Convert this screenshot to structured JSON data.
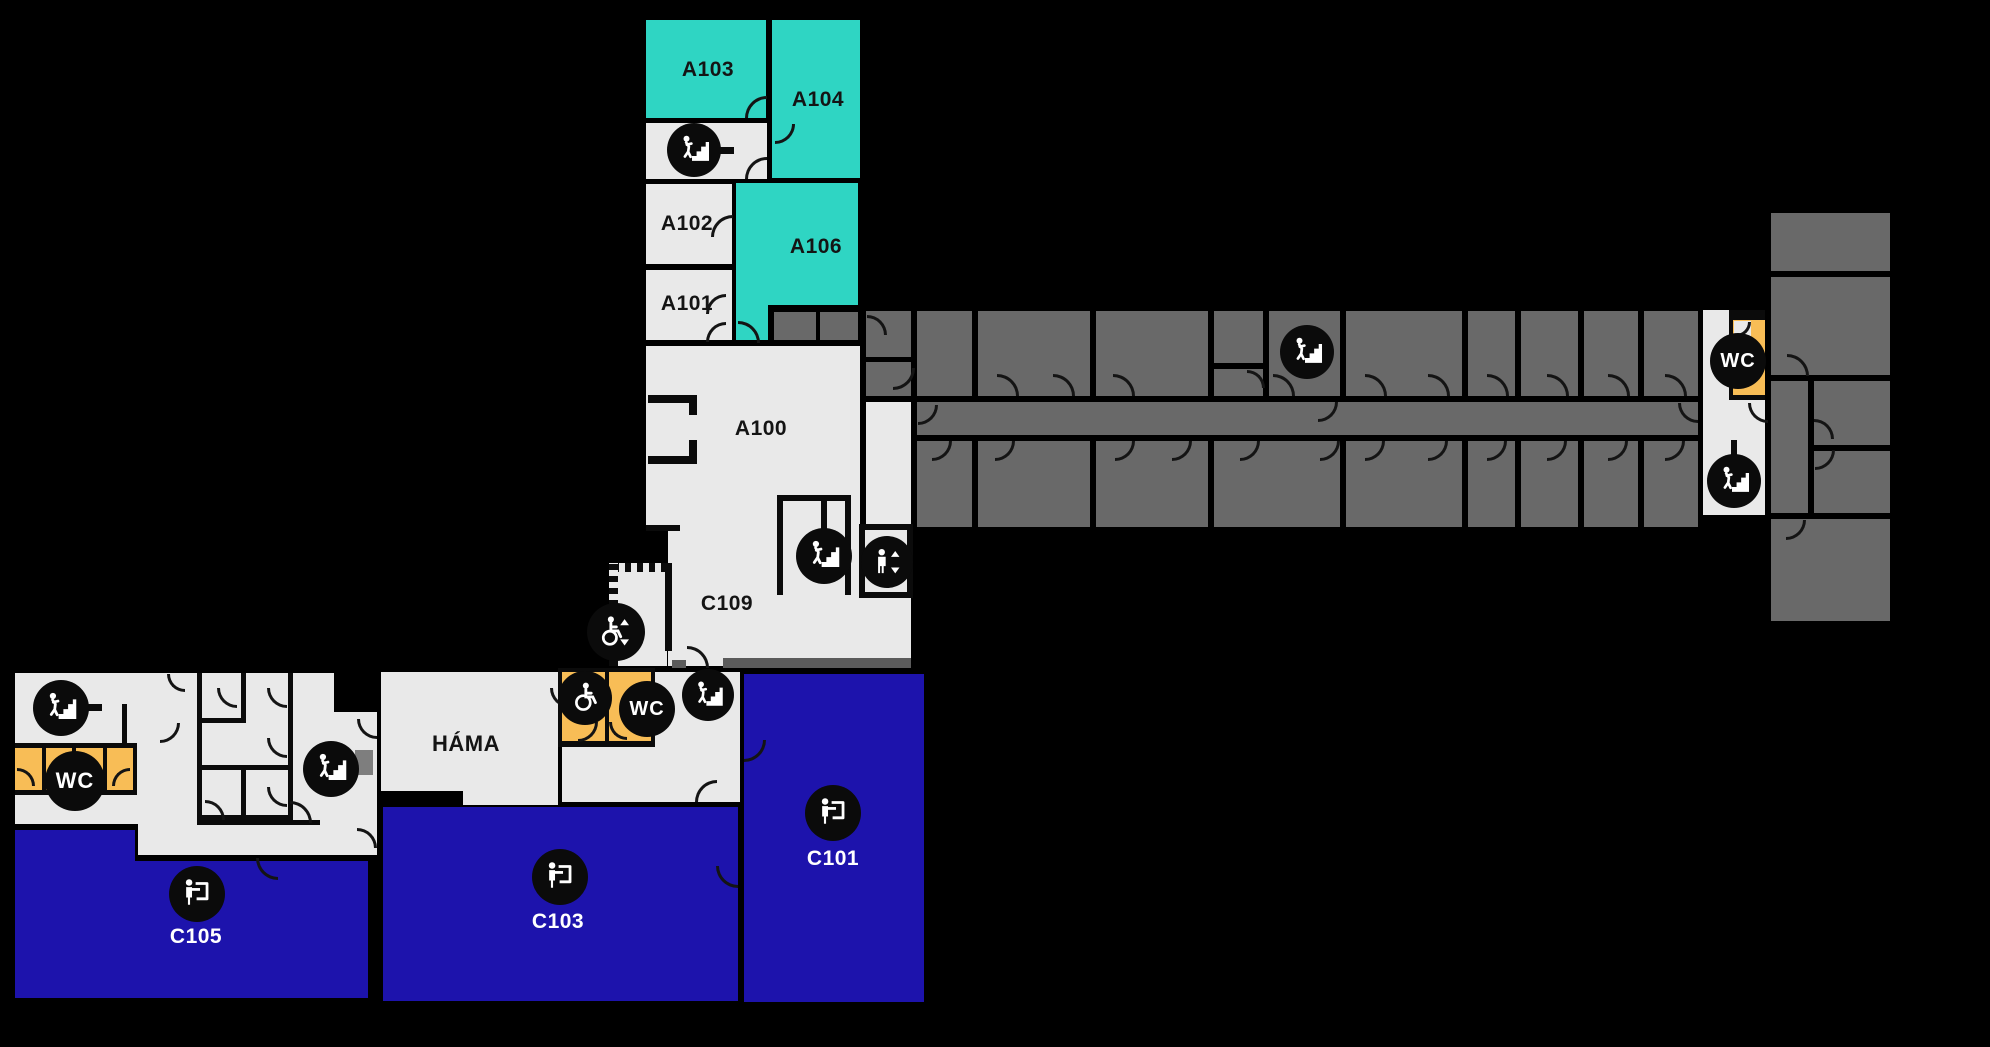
{
  "canvas": {
    "w": 1990,
    "h": 1047,
    "bg": "#000000"
  },
  "palette": {
    "wall": "#0B0B0B",
    "light": "#E9E9E9",
    "dark": "#696969",
    "teal": "#2FD5C3",
    "blue": "#1D13AC",
    "orange": "#F8BD56",
    "mid": "#5B5B5B",
    "mid2": "#7E7E7E",
    "label_dark": "#141414",
    "label_light": "#FFFFFF",
    "icon_bg": "#0B0B0B"
  },
  "rooms": [
    {
      "id": "a103",
      "x": 646,
      "y": 20,
      "w": 120,
      "h": 98,
      "fill": "teal"
    },
    {
      "id": "a104",
      "x": 772,
      "y": 20,
      "w": 88,
      "h": 158,
      "fill": "teal"
    },
    {
      "id": "stair-room-a",
      "x": 646,
      "y": 123,
      "w": 121,
      "h": 56,
      "fill": "light"
    },
    {
      "id": "a102",
      "x": 646,
      "y": 184,
      "w": 86,
      "h": 80,
      "fill": "light"
    },
    {
      "id": "a106",
      "x": 736,
      "y": 183,
      "w": 122,
      "h": 122,
      "fill": "teal"
    },
    {
      "id": "a106-ext",
      "x": 736,
      "y": 303,
      "w": 32,
      "h": 37,
      "fill": "teal"
    },
    {
      "id": "a101",
      "x": 646,
      "y": 270,
      "w": 86,
      "h": 70,
      "fill": "light"
    },
    {
      "id": "closet-1",
      "x": 774,
      "y": 312,
      "w": 42,
      "h": 28,
      "fill": "dark"
    },
    {
      "id": "closet-2",
      "x": 820,
      "y": 312,
      "w": 38,
      "h": 28,
      "fill": "dark"
    },
    {
      "id": "a100",
      "x": 646,
      "y": 346,
      "w": 214,
      "h": 185,
      "fill": "light"
    },
    {
      "id": "c109",
      "x": 668,
      "y": 527,
      "w": 243,
      "h": 139,
      "fill": "light"
    },
    {
      "id": "c109-ramp",
      "x": 613,
      "y": 565,
      "w": 54,
      "h": 101,
      "fill": "light"
    },
    {
      "id": "east-junction",
      "x": 866,
      "y": 402,
      "w": 45,
      "h": 128,
      "fill": "light"
    },
    {
      "id": "east-corridor",
      "x": 917,
      "y": 402,
      "w": 781,
      "h": 33,
      "fill": "dark"
    },
    {
      "id": "east-room-1a",
      "x": 866,
      "y": 311,
      "w": 45,
      "h": 46,
      "fill": "dark"
    },
    {
      "id": "east-room-1b",
      "x": 866,
      "y": 362,
      "w": 45,
      "h": 34,
      "fill": "dark"
    },
    {
      "id": "east-room-2",
      "x": 917,
      "y": 311,
      "w": 55,
      "h": 85,
      "fill": "dark"
    },
    {
      "id": "east-room-3",
      "x": 978,
      "y": 311,
      "w": 112,
      "h": 85,
      "fill": "dark"
    },
    {
      "id": "east-room-4",
      "x": 1096,
      "y": 311,
      "w": 112,
      "h": 85,
      "fill": "dark"
    },
    {
      "id": "east-room-5a",
      "x": 1214,
      "y": 311,
      "w": 49,
      "h": 52,
      "fill": "dark"
    },
    {
      "id": "east-room-5b",
      "x": 1214,
      "y": 369,
      "w": 49,
      "h": 27,
      "fill": "dark"
    },
    {
      "id": "east-stair-room",
      "x": 1269,
      "y": 311,
      "w": 71,
      "h": 85,
      "fill": "dark"
    },
    {
      "id": "east-room-6",
      "x": 1346,
      "y": 311,
      "w": 116,
      "h": 85,
      "fill": "dark"
    },
    {
      "id": "east-room-7",
      "x": 1468,
      "y": 311,
      "w": 47,
      "h": 85,
      "fill": "dark"
    },
    {
      "id": "east-room-8",
      "x": 1521,
      "y": 311,
      "w": 57,
      "h": 85,
      "fill": "dark"
    },
    {
      "id": "east-room-9",
      "x": 1584,
      "y": 311,
      "w": 54,
      "h": 85,
      "fill": "dark"
    },
    {
      "id": "east-room-10",
      "x": 1644,
      "y": 311,
      "w": 54,
      "h": 85,
      "fill": "dark"
    },
    {
      "id": "east-room-11",
      "x": 917,
      "y": 441,
      "w": 55,
      "h": 86,
      "fill": "dark"
    },
    {
      "id": "east-room-12",
      "x": 978,
      "y": 441,
      "w": 112,
      "h": 86,
      "fill": "dark"
    },
    {
      "id": "east-room-13",
      "x": 1096,
      "y": 441,
      "w": 112,
      "h": 86,
      "fill": "dark"
    },
    {
      "id": "east-room-14",
      "x": 1214,
      "y": 441,
      "w": 126,
      "h": 86,
      "fill": "dark"
    },
    {
      "id": "east-room-15",
      "x": 1346,
      "y": 441,
      "w": 116,
      "h": 86,
      "fill": "dark"
    },
    {
      "id": "east-room-16",
      "x": 1468,
      "y": 441,
      "w": 47,
      "h": 86,
      "fill": "dark"
    },
    {
      "id": "east-room-17",
      "x": 1521,
      "y": 441,
      "w": 57,
      "h": 86,
      "fill": "dark"
    },
    {
      "id": "east-room-18",
      "x": 1584,
      "y": 441,
      "w": 54,
      "h": 86,
      "fill": "dark"
    },
    {
      "id": "east-room-19",
      "x": 1644,
      "y": 441,
      "w": 54,
      "h": 86,
      "fill": "dark"
    },
    {
      "id": "east-end-hall",
      "x": 1703,
      "y": 310,
      "w": 62,
      "h": 205,
      "fill": "light"
    },
    {
      "id": "east-wc-frame",
      "x": 1729,
      "y": 310,
      "w": 36,
      "h": 90,
      "fill": "wall"
    },
    {
      "id": "east-wc",
      "x": 1733,
      "y": 320,
      "w": 32,
      "h": 75,
      "fill": "orange"
    },
    {
      "id": "east-wc-door-nook",
      "x": 1734,
      "y": 321,
      "w": 17,
      "h": 15,
      "fill": "light"
    },
    {
      "id": "far-room-1",
      "x": 1771,
      "y": 213,
      "w": 119,
      "h": 58,
      "fill": "dark"
    },
    {
      "id": "far-room-2",
      "x": 1771,
      "y": 277,
      "w": 119,
      "h": 98,
      "fill": "dark"
    },
    {
      "id": "far-room-3",
      "x": 1771,
      "y": 381,
      "w": 37,
      "h": 132,
      "fill": "dark"
    },
    {
      "id": "far-room-4",
      "x": 1814,
      "y": 381,
      "w": 76,
      "h": 64,
      "fill": "dark"
    },
    {
      "id": "far-room-5",
      "x": 1814,
      "y": 451,
      "w": 76,
      "h": 62,
      "fill": "dark"
    },
    {
      "id": "far-room-6",
      "x": 1771,
      "y": 519,
      "w": 119,
      "h": 102,
      "fill": "dark"
    },
    {
      "id": "west-base",
      "x": 15,
      "y": 673,
      "w": 319,
      "h": 151,
      "fill": "light"
    },
    {
      "id": "west-annex",
      "x": 334,
      "y": 712,
      "w": 43,
      "h": 143,
      "fill": "light"
    },
    {
      "id": "west-strip",
      "x": 138,
      "y": 798,
      "w": 239,
      "h": 57,
      "fill": "light"
    },
    {
      "id": "west-stall-frame",
      "x": 15,
      "y": 743,
      "w": 122,
      "h": 52,
      "fill": "wall"
    },
    {
      "id": "west-stall-1",
      "x": 15,
      "y": 748,
      "w": 27,
      "h": 42,
      "fill": "orange"
    },
    {
      "id": "west-stall-2",
      "x": 46,
      "y": 748,
      "w": 26,
      "h": 42,
      "fill": "orange"
    },
    {
      "id": "west-stall-3",
      "x": 76,
      "y": 748,
      "w": 27,
      "h": 42,
      "fill": "orange"
    },
    {
      "id": "west-stall-4",
      "x": 107,
      "y": 748,
      "w": 26,
      "h": 42,
      "fill": "orange"
    },
    {
      "id": "hama",
      "x": 381,
      "y": 672,
      "w": 177,
      "h": 119,
      "fill": "light"
    },
    {
      "id": "hama-step",
      "x": 463,
      "y": 789,
      "w": 95,
      "h": 16,
      "fill": "light"
    },
    {
      "id": "south-hall",
      "x": 562,
      "y": 672,
      "w": 178,
      "h": 130,
      "fill": "light"
    },
    {
      "id": "south-wc-frame",
      "x": 558,
      "y": 668,
      "w": 97,
      "h": 79,
      "fill": "wall"
    },
    {
      "id": "acc-wc",
      "x": 562,
      "y": 672,
      "w": 43,
      "h": 69,
      "fill": "orange"
    },
    {
      "id": "south-wc",
      "x": 609,
      "y": 672,
      "w": 42,
      "h": 69,
      "fill": "orange"
    },
    {
      "id": "c101",
      "x": 744,
      "y": 674,
      "w": 180,
      "h": 328,
      "fill": "blue"
    },
    {
      "id": "c103",
      "x": 383,
      "y": 807,
      "w": 355,
      "h": 194,
      "fill": "blue"
    },
    {
      "id": "c105-left",
      "x": 15,
      "y": 830,
      "w": 120,
      "h": 168,
      "fill": "blue"
    },
    {
      "id": "c105-right",
      "x": 133,
      "y": 861,
      "w": 235,
      "h": 137,
      "fill": "blue"
    }
  ],
  "walls": [
    {
      "x": 646,
      "y": 525,
      "w": 34,
      "h": 6
    },
    {
      "x": 777,
      "y": 495,
      "w": 74,
      "h": 6
    },
    {
      "x": 777,
      "y": 495,
      "w": 6,
      "h": 100
    },
    {
      "x": 845,
      "y": 495,
      "w": 6,
      "h": 100
    },
    {
      "x": 821,
      "y": 499,
      "w": 6,
      "h": 32
    },
    {
      "x": 859,
      "y": 524,
      "w": 54,
      "h": 6
    },
    {
      "x": 859,
      "y": 524,
      "w": 6,
      "h": 74
    },
    {
      "x": 907,
      "y": 524,
      "w": 6,
      "h": 74
    },
    {
      "x": 859,
      "y": 592,
      "w": 54,
      "h": 6
    },
    {
      "x": 648,
      "y": 395,
      "w": 49,
      "h": 8
    },
    {
      "x": 689,
      "y": 395,
      "w": 8,
      "h": 20
    },
    {
      "x": 648,
      "y": 456,
      "w": 49,
      "h": 8
    },
    {
      "x": 689,
      "y": 440,
      "w": 8,
      "h": 24
    },
    {
      "x": 665,
      "y": 563,
      "w": 7,
      "h": 88
    },
    {
      "x": 613,
      "y": 563,
      "w": 54,
      "h": 9,
      "saw": "h"
    },
    {
      "x": 609,
      "y": 563,
      "w": 9,
      "h": 103,
      "saw": "v"
    },
    {
      "x": 672,
      "y": 660,
      "w": 14,
      "h": 8,
      "fill": "mid"
    },
    {
      "x": 723,
      "y": 658,
      "w": 188,
      "h": 10,
      "fill": "mid"
    },
    {
      "x": 197,
      "y": 673,
      "w": 5,
      "h": 147
    },
    {
      "x": 241,
      "y": 673,
      "w": 5,
      "h": 45
    },
    {
      "x": 197,
      "y": 718,
      "w": 49,
      "h": 5
    },
    {
      "x": 241,
      "y": 768,
      "w": 5,
      "h": 50
    },
    {
      "x": 197,
      "y": 765,
      "w": 91,
      "h": 5
    },
    {
      "x": 197,
      "y": 815,
      "w": 91,
      "h": 5
    },
    {
      "x": 288,
      "y": 673,
      "w": 5,
      "h": 147
    },
    {
      "x": 197,
      "y": 820,
      "w": 123,
      "h": 5
    },
    {
      "x": 355,
      "y": 750,
      "w": 18,
      "h": 25,
      "fill": "mid2"
    },
    {
      "x": 718,
      "y": 147,
      "w": 16,
      "h": 7
    },
    {
      "x": 85,
      "y": 704,
      "w": 17,
      "h": 7
    },
    {
      "x": 122,
      "y": 704,
      "w": 5,
      "h": 40
    },
    {
      "x": 1731,
      "y": 440,
      "w": 6,
      "h": 16
    }
  ],
  "doors": [
    {
      "x": 745,
      "y": 96,
      "s": 22,
      "r": 0
    },
    {
      "x": 775,
      "y": 124,
      "s": 20,
      "r": 180
    },
    {
      "x": 745,
      "y": 157,
      "s": 22,
      "r": 0
    },
    {
      "x": 711,
      "y": 215,
      "s": 22,
      "r": 0
    },
    {
      "x": 706,
      "y": 294,
      "s": 20,
      "r": 0
    },
    {
      "x": 706,
      "y": 322,
      "s": 20,
      "r": 0
    },
    {
      "x": 738,
      "y": 321,
      "s": 22,
      "r": 90
    },
    {
      "x": 893,
      "y": 368,
      "s": 22,
      "r": 180
    },
    {
      "x": 867,
      "y": 315,
      "s": 20,
      "r": 90
    },
    {
      "x": 918,
      "y": 405,
      "s": 20,
      "r": 180
    },
    {
      "x": 687,
      "y": 646,
      "s": 22,
      "r": 90
    },
    {
      "x": 997,
      "y": 374,
      "s": 22,
      "r": 90
    },
    {
      "x": 1053,
      "y": 374,
      "s": 22,
      "r": 90
    },
    {
      "x": 1113,
      "y": 374,
      "s": 22,
      "r": 90
    },
    {
      "x": 1247,
      "y": 370,
      "s": 18,
      "r": 90
    },
    {
      "x": 1273,
      "y": 374,
      "s": 22,
      "r": 90
    },
    {
      "x": 1365,
      "y": 374,
      "s": 22,
      "r": 90
    },
    {
      "x": 1428,
      "y": 374,
      "s": 22,
      "r": 90
    },
    {
      "x": 1487,
      "y": 374,
      "s": 22,
      "r": 90
    },
    {
      "x": 1547,
      "y": 374,
      "s": 22,
      "r": 90
    },
    {
      "x": 1608,
      "y": 374,
      "s": 22,
      "r": 90
    },
    {
      "x": 1665,
      "y": 374,
      "s": 22,
      "r": 90
    },
    {
      "x": 1318,
      "y": 402,
      "s": 20,
      "r": 180
    },
    {
      "x": 1678,
      "y": 403,
      "s": 20,
      "r": 270
    },
    {
      "x": 932,
      "y": 441,
      "s": 20,
      "r": 180
    },
    {
      "x": 995,
      "y": 441,
      "s": 20,
      "r": 180
    },
    {
      "x": 1115,
      "y": 441,
      "s": 20,
      "r": 180
    },
    {
      "x": 1172,
      "y": 441,
      "s": 20,
      "r": 180
    },
    {
      "x": 1240,
      "y": 441,
      "s": 20,
      "r": 180
    },
    {
      "x": 1320,
      "y": 441,
      "s": 20,
      "r": 180
    },
    {
      "x": 1365,
      "y": 441,
      "s": 20,
      "r": 180
    },
    {
      "x": 1428,
      "y": 441,
      "s": 20,
      "r": 180
    },
    {
      "x": 1487,
      "y": 441,
      "s": 20,
      "r": 180
    },
    {
      "x": 1547,
      "y": 441,
      "s": 20,
      "r": 180
    },
    {
      "x": 1608,
      "y": 441,
      "s": 20,
      "r": 180
    },
    {
      "x": 1665,
      "y": 441,
      "s": 20,
      "r": 180
    },
    {
      "x": 1736,
      "y": 322,
      "s": 15,
      "r": 180
    },
    {
      "x": 1748,
      "y": 403,
      "s": 20,
      "r": 270
    },
    {
      "x": 1787,
      "y": 354,
      "s": 22,
      "r": 90
    },
    {
      "x": 1814,
      "y": 419,
      "s": 20,
      "r": 90
    },
    {
      "x": 1815,
      "y": 450,
      "s": 20,
      "r": 180
    },
    {
      "x": 1786,
      "y": 520,
      "s": 20,
      "r": 180
    },
    {
      "x": 550,
      "y": 688,
      "s": 20,
      "r": 270
    },
    {
      "x": 578,
      "y": 722,
      "s": 20,
      "r": 180
    },
    {
      "x": 609,
      "y": 722,
      "s": 18,
      "r": 270
    },
    {
      "x": 695,
      "y": 780,
      "s": 22,
      "r": 0
    },
    {
      "x": 256,
      "y": 858,
      "s": 22,
      "r": 270
    },
    {
      "x": 716,
      "y": 866,
      "s": 22,
      "r": 270
    },
    {
      "x": 744,
      "y": 740,
      "s": 22,
      "r": 180
    },
    {
      "x": 17,
      "y": 768,
      "s": 18,
      "r": 90
    },
    {
      "x": 112,
      "y": 768,
      "s": 18,
      "r": 0
    },
    {
      "x": 167,
      "y": 674,
      "s": 18,
      "r": 270
    },
    {
      "x": 217,
      "y": 688,
      "s": 20,
      "r": 270
    },
    {
      "x": 267,
      "y": 688,
      "s": 20,
      "r": 270
    },
    {
      "x": 160,
      "y": 723,
      "s": 20,
      "r": 180
    },
    {
      "x": 267,
      "y": 738,
      "s": 20,
      "r": 270
    },
    {
      "x": 205,
      "y": 800,
      "s": 20,
      "r": 90
    },
    {
      "x": 267,
      "y": 787,
      "s": 20,
      "r": 270
    },
    {
      "x": 290,
      "y": 801,
      "s": 22,
      "r": 90
    },
    {
      "x": 357,
      "y": 719,
      "s": 20,
      "r": 270
    },
    {
      "x": 357,
      "y": 828,
      "s": 20,
      "r": 90
    }
  ],
  "icons": [
    {
      "type": "stairs",
      "x": 694,
      "y": 150,
      "d": 54
    },
    {
      "type": "stairs",
      "x": 824,
      "y": 556,
      "d": 56
    },
    {
      "type": "elevator",
      "x": 887,
      "y": 562,
      "d": 52
    },
    {
      "type": "wheelchair-lift",
      "x": 616,
      "y": 632,
      "d": 58
    },
    {
      "type": "stairs",
      "x": 1307,
      "y": 352,
      "d": 54
    },
    {
      "type": "wc",
      "x": 1738,
      "y": 361,
      "d": 56,
      "text": "WC"
    },
    {
      "type": "stairs",
      "x": 1734,
      "y": 481,
      "d": 54
    },
    {
      "type": "stairs",
      "x": 61,
      "y": 708,
      "d": 56
    },
    {
      "type": "wc",
      "x": 75,
      "y": 781,
      "d": 60,
      "text": "WC"
    },
    {
      "type": "stairs",
      "x": 331,
      "y": 769,
      "d": 56
    },
    {
      "type": "wheelchair",
      "x": 585,
      "y": 698,
      "d": 54
    },
    {
      "type": "wc",
      "x": 647,
      "y": 709,
      "d": 56,
      "text": "WC"
    },
    {
      "type": "stairs",
      "x": 708,
      "y": 695,
      "d": 52
    },
    {
      "type": "classroom",
      "x": 197,
      "y": 894,
      "d": 56
    },
    {
      "type": "classroom",
      "x": 560,
      "y": 877,
      "d": 56
    },
    {
      "type": "classroom",
      "x": 833,
      "y": 813,
      "d": 56
    }
  ],
  "labels": [
    {
      "text": "A103",
      "x": 708,
      "y": 70,
      "color": "#141414"
    },
    {
      "text": "A104",
      "x": 818,
      "y": 100,
      "color": "#141414"
    },
    {
      "text": "A102",
      "x": 687,
      "y": 224,
      "color": "#141414"
    },
    {
      "text": "A106",
      "x": 816,
      "y": 247,
      "color": "#141414"
    },
    {
      "text": "A101",
      "x": 687,
      "y": 304,
      "color": "#141414"
    },
    {
      "text": "A100",
      "x": 761,
      "y": 429,
      "color": "#141414"
    },
    {
      "text": "C109",
      "x": 727,
      "y": 604,
      "color": "#141414"
    },
    {
      "text": "HÁMA",
      "x": 466,
      "y": 744,
      "color": "#141414",
      "size": 22
    },
    {
      "text": "C101",
      "x": 833,
      "y": 859,
      "color": "#FFFFFF"
    },
    {
      "text": "C103",
      "x": 558,
      "y": 922,
      "color": "#FFFFFF"
    },
    {
      "text": "C105",
      "x": 196,
      "y": 937,
      "color": "#FFFFFF"
    }
  ]
}
